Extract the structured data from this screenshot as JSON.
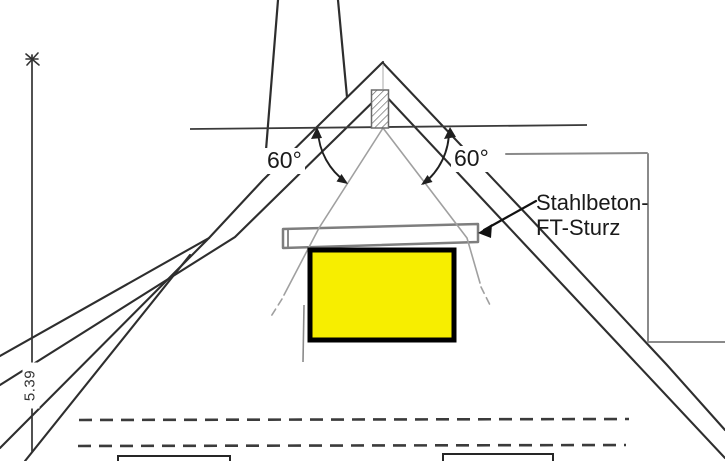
{
  "drawing": {
    "angle_left_label": "60°",
    "angle_right_label": "60°",
    "lintel_label": {
      "line1": "Stahlbeton-",
      "line2": "FT-Sturz"
    },
    "height_dimension_label": "5.39"
  },
  "colors": {
    "window_highlight_fill": "#F7EE00",
    "window_highlight_border": "#000000",
    "ink_dark": "#2E2E2E",
    "sketch_light_gray": "#A0A0A0",
    "bracket_gray": "#8A8A8A",
    "background": "#FFFFFF"
  }
}
